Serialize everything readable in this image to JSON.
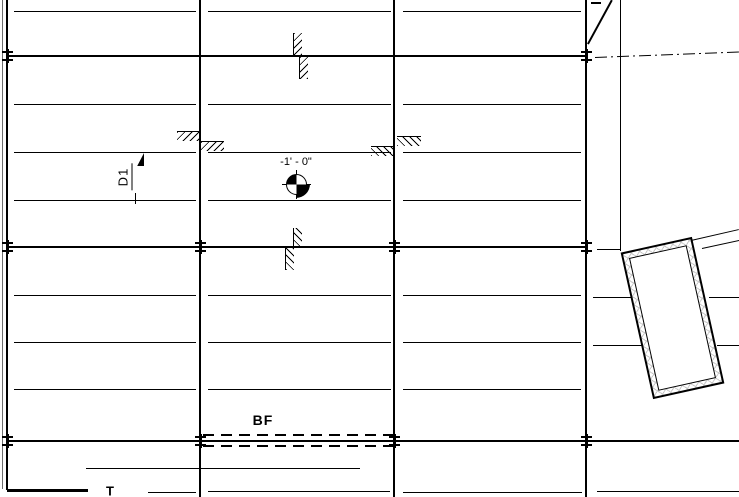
{
  "app": {
    "view": "structural-plan-canvas"
  },
  "colors": {
    "ink": "#000000",
    "paper": "#ffffff",
    "edge_line": "#6e6e6e",
    "pad_hatch": "#c8c8c8"
  },
  "labels": {
    "bf": {
      "text": "BF",
      "x": 263,
      "y": 420
    },
    "d1": {
      "text": "D1",
      "x": 124,
      "y": 177
    },
    "t": {
      "text": "T",
      "x": 110,
      "y": 491
    },
    "spot": {
      "text": "-1' - 0\"",
      "x": 296,
      "y": 162
    }
  },
  "drawing": {
    "vlines": [
      {
        "name": "view-edge-line",
        "x": 2,
        "y1": 0,
        "y2": 489,
        "w": 1,
        "color": "#6e6e6e"
      },
      {
        "name": "grid-line-a",
        "x": 7,
        "y1": 0,
        "y2": 490,
        "w": 2.4
      },
      {
        "name": "grid-line-b",
        "x": 200,
        "y1": 0,
        "y2": 497,
        "w": 2
      },
      {
        "name": "grid-line-c",
        "x": 394,
        "y1": 0,
        "y2": 497,
        "w": 1.6
      },
      {
        "name": "grid-line-d",
        "x": 586,
        "y1": 0,
        "y2": 497,
        "w": 2.4
      },
      {
        "name": "wall-edge-line",
        "x": 620,
        "y1": 0,
        "y2": 251,
        "w": 1
      },
      {
        "name": "d1-extension-tick",
        "x": 135,
        "y1": 193,
        "y2": 204,
        "w": 1
      }
    ],
    "hlines": [
      {
        "name": "wall-line",
        "y": 56,
        "x1": 7,
        "x2": 587,
        "w": 2.4
      },
      {
        "name": "wall-line",
        "y": 247,
        "x1": 7,
        "x2": 587,
        "w": 2.4
      },
      {
        "name": "footing-line-bf",
        "y": 441,
        "x1": 7,
        "x2": 739,
        "w": 2.6
      },
      {
        "name": "wall-corner-line",
        "y": 490,
        "x1": 7,
        "x2": 88,
        "w": 3
      },
      {
        "name": "top-dash",
        "y": 3,
        "x1": 591,
        "x2": 601,
        "w": 2
      },
      {
        "name": "framing-line",
        "y": 11,
        "x1": 14,
        "x2": 196,
        "w": 1
      },
      {
        "name": "framing-line",
        "y": 11,
        "x1": 208,
        "x2": 391,
        "w": 1
      },
      {
        "name": "framing-line",
        "y": 11,
        "x1": 403,
        "x2": 581,
        "w": 1
      },
      {
        "name": "framing-line",
        "y": 104,
        "x1": 14,
        "x2": 196,
        "w": 1
      },
      {
        "name": "framing-line",
        "y": 104,
        "x1": 208,
        "x2": 391,
        "w": 1
      },
      {
        "name": "framing-line",
        "y": 104,
        "x1": 403,
        "x2": 581,
        "w": 1
      },
      {
        "name": "framing-line",
        "y": 152,
        "x1": 14,
        "x2": 196,
        "w": 1
      },
      {
        "name": "framing-line",
        "y": 152,
        "x1": 208,
        "x2": 391,
        "w": 1
      },
      {
        "name": "framing-line",
        "y": 152,
        "x1": 403,
        "x2": 581,
        "w": 1
      },
      {
        "name": "framing-line",
        "y": 200,
        "x1": 14,
        "x2": 196,
        "w": 1
      },
      {
        "name": "framing-line",
        "y": 200,
        "x1": 208,
        "x2": 391,
        "w": 1
      },
      {
        "name": "framing-line",
        "y": 200,
        "x1": 403,
        "x2": 581,
        "w": 1
      },
      {
        "name": "framing-line",
        "y": 295,
        "x1": 14,
        "x2": 196,
        "w": 1
      },
      {
        "name": "framing-line",
        "y": 295,
        "x1": 208,
        "x2": 391,
        "w": 1
      },
      {
        "name": "framing-line",
        "y": 295,
        "x1": 403,
        "x2": 581,
        "w": 1
      },
      {
        "name": "framing-line",
        "y": 342,
        "x1": 14,
        "x2": 196,
        "w": 1
      },
      {
        "name": "framing-line",
        "y": 342,
        "x1": 208,
        "x2": 391,
        "w": 1
      },
      {
        "name": "framing-line",
        "y": 342,
        "x1": 403,
        "x2": 581,
        "w": 1
      },
      {
        "name": "framing-line",
        "y": 389,
        "x1": 14,
        "x2": 196,
        "w": 1
      },
      {
        "name": "framing-line",
        "y": 389,
        "x1": 208,
        "x2": 391,
        "w": 1
      },
      {
        "name": "framing-line",
        "y": 389,
        "x1": 403,
        "x2": 581,
        "w": 1
      },
      {
        "name": "framing-line",
        "y": 249,
        "x1": 597,
        "x2": 620,
        "w": 1
      },
      {
        "name": "framing-line",
        "y": 297,
        "x1": 593,
        "x2": 631,
        "w": 1
      },
      {
        "name": "framing-line",
        "y": 297,
        "x1": 709,
        "x2": 739,
        "w": 1
      },
      {
        "name": "framing-line",
        "y": 345,
        "x1": 593,
        "x2": 643,
        "w": 1
      },
      {
        "name": "framing-line",
        "y": 345,
        "x1": 717,
        "x2": 739,
        "w": 1
      },
      {
        "name": "boundary-line",
        "y": 468,
        "x1": 86,
        "x2": 360,
        "w": 1
      },
      {
        "name": "boundary-line",
        "y": 492,
        "x1": 148,
        "x2": 196,
        "w": 1
      },
      {
        "name": "boundary-line",
        "y": 491,
        "x1": 208,
        "x2": 390,
        "w": 1
      },
      {
        "name": "boundary-line",
        "y": 492,
        "x1": 403,
        "x2": 582,
        "w": 1
      },
      {
        "name": "boundary-line",
        "y": 491,
        "x1": 597,
        "x2": 739,
        "w": 1
      }
    ],
    "dashed_hlines": [
      {
        "name": "footing-dashed-edge",
        "y": 435,
        "x1": 203,
        "x2": 399,
        "w": 1.8
      },
      {
        "name": "footing-dashed-edge",
        "y": 446,
        "x1": 203,
        "x2": 399,
        "w": 1.8
      }
    ],
    "dashdot_lines": [
      {
        "name": "centerline",
        "x1": 595,
        "y1": 57.5,
        "x2": 739,
        "y2": 52,
        "w": 1.2
      }
    ],
    "diagonals": [
      {
        "name": "section-cut-line",
        "x1": 588,
        "y1": 44,
        "x2": 612,
        "y2": 0,
        "w": 2.2
      },
      {
        "name": "wall-extension-line",
        "x1": 691,
        "y1": 240,
        "x2": 739,
        "y2": 229,
        "w": 1
      },
      {
        "name": "wall-extension-line",
        "x1": 702,
        "y1": 248,
        "x2": 739,
        "y2": 240,
        "w": 1
      }
    ],
    "step_hatches": [
      {
        "x": 177,
        "y": 131,
        "w": 24,
        "h": 10,
        "dir": "/",
        "edge": "top"
      },
      {
        "x": 201,
        "y": 141,
        "w": 23,
        "h": 10,
        "dir": "/",
        "edge": "top"
      },
      {
        "x": 371,
        "y": 146,
        "w": 24,
        "h": 10,
        "dir": "\\",
        "edge": "top"
      },
      {
        "x": 397,
        "y": 136,
        "w": 24,
        "h": 10,
        "dir": "\\",
        "edge": "top"
      },
      {
        "x": 293,
        "y": 33,
        "w": 9,
        "h": 24,
        "dir": "/",
        "edge": "left"
      },
      {
        "x": 299,
        "y": 57,
        "w": 9,
        "h": 22,
        "dir": "/",
        "edge": "left"
      },
      {
        "x": 293,
        "y": 228,
        "w": 9,
        "h": 20,
        "dir": "\\",
        "edge": "left"
      },
      {
        "x": 285,
        "y": 248,
        "w": 9,
        "h": 22,
        "dir": "\\",
        "edge": "left"
      }
    ],
    "grid_ticks": [
      {
        "x": 7,
        "y": 56
      },
      {
        "x": 586,
        "y": 56
      },
      {
        "x": 7,
        "y": 247
      },
      {
        "x": 200,
        "y": 247
      },
      {
        "x": 394,
        "y": 247
      },
      {
        "x": 586,
        "y": 247
      },
      {
        "x": 7,
        "y": 441
      },
      {
        "x": 200,
        "y": 441
      },
      {
        "x": 394,
        "y": 441
      },
      {
        "x": 586,
        "y": 441
      }
    ],
    "spot_marker": {
      "cx": 296,
      "cy": 184,
      "r": 10.5,
      "ring_r": 14
    },
    "d1_flag": {
      "x": 136,
      "y": 153
    },
    "pad_outline": {
      "cx": 672,
      "cy": 318,
      "w": 73,
      "h": 150,
      "angle": -12.5
    }
  }
}
